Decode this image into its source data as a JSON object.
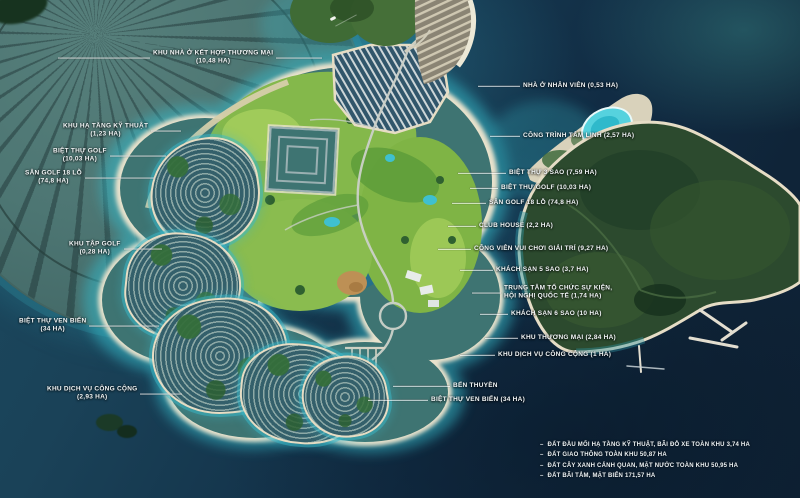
{
  "palette": {
    "ocean_deep": "#112a40",
    "ocean_mid": "#1d4a60",
    "shallow": "#3ab8c8",
    "sand": "#e9e2cc",
    "golf_green": "#85b94c",
    "golf_dark": "#5d9c3a",
    "forest_green": "#2c4a2e",
    "villa_base": "#3e7472",
    "fan_land": "#4e7876",
    "lagoon": "#56d2de",
    "label_text": "#f2f6f7",
    "leader_line": "rgba(255,255,255,0.8)"
  },
  "map_labels": [
    {
      "id": "khu-nha-o-ket-hop-thuong-mai",
      "side": "left",
      "x": 58,
      "y": 58,
      "pre": 92,
      "post": 46,
      "lines": [
        "KHU NHÀ Ở KẾT HỢP THƯƠNG MẠI",
        "(10,48 HA)"
      ]
    },
    {
      "id": "khu-ha-tang-ky-thuat",
      "side": "left",
      "x": 60,
      "y": 131,
      "pre": 0,
      "post": 30,
      "lines": [
        "KHU HẠ TẦNG KỸ THUẬT",
        "(1,23 HA)"
      ]
    },
    {
      "id": "biet-thu-golf-left",
      "side": "left",
      "x": 50,
      "y": 156,
      "pre": 0,
      "post": 56,
      "lines": [
        "BIỆT THỰ GOLF",
        "(10,03 HA)"
      ]
    },
    {
      "id": "san-golf-18-lo-left",
      "side": "left",
      "x": 22,
      "y": 178,
      "pre": 0,
      "post": 70,
      "lines": [
        "SÂN GOLF 18 LỖ",
        "(74,8 HA)"
      ]
    },
    {
      "id": "khu-tap-golf",
      "side": "left",
      "x": 66,
      "y": 249,
      "pre": 0,
      "post": 38,
      "lines": [
        "KHU TẬP GOLF",
        "(0,28 HA)"
      ]
    },
    {
      "id": "biet-thu-ven-bien-left",
      "side": "left",
      "x": 16,
      "y": 326,
      "pre": 0,
      "post": 70,
      "lines": [
        "BIỆT THỰ VEN BIỂN",
        "(34 HA)"
      ]
    },
    {
      "id": "khu-dich-vu-cong-cong-left",
      "side": "left",
      "x": 44,
      "y": 394,
      "pre": 0,
      "post": 42,
      "lines": [
        "KHU DỊCH VỤ CÔNG CỘNG",
        "(2,93 HA)"
      ]
    },
    {
      "id": "nha-o-nhan-vien",
      "side": "right",
      "x": 478,
      "y": 86,
      "pre": 42,
      "post": 0,
      "lines": [
        "NHÀ Ở NHÂN VIÊN (0,53 HA)"
      ]
    },
    {
      "id": "cong-trinh-tam-linh",
      "side": "right",
      "x": 490,
      "y": 136,
      "pre": 30,
      "post": 0,
      "lines": [
        "CÔNG TRÌNH TÂM LINH (2,57 HA)"
      ]
    },
    {
      "id": "biet-thu-3-sao",
      "side": "right",
      "x": 458,
      "y": 173,
      "pre": 48,
      "post": 0,
      "lines": [
        "BIỆT THỰ 3 SAO (7,59 HA)"
      ]
    },
    {
      "id": "biet-thu-golf-right",
      "side": "right",
      "x": 470,
      "y": 188,
      "pre": 28,
      "post": 0,
      "lines": [
        "BIỆT THỰ GOLF (10,03 HA)"
      ]
    },
    {
      "id": "san-golf-18-lo-right",
      "side": "right",
      "x": 452,
      "y": 203,
      "pre": 34,
      "post": 0,
      "lines": [
        "SÂN GOLF 18 LỖ (74,8 HA)"
      ]
    },
    {
      "id": "club-house",
      "side": "right",
      "x": 448,
      "y": 226,
      "pre": 28,
      "post": 0,
      "lines": [
        "CLUB HOUSE (2,2 HA)"
      ]
    },
    {
      "id": "cong-vien-vui-choi-giai-tri",
      "side": "right",
      "x": 438,
      "y": 249,
      "pre": 33,
      "post": 0,
      "lines": [
        "CÔNG VIÊN VUI CHƠI GIẢI TRÍ (9,27 HA)"
      ]
    },
    {
      "id": "khach-san-5-sao",
      "side": "right",
      "x": 460,
      "y": 270,
      "pre": 33,
      "post": 0,
      "lines": [
        "KHÁCH SẠN 5 SAO (3,7 HA)"
      ]
    },
    {
      "id": "trung-tam-su-kien",
      "side": "right",
      "x": 472,
      "y": 293,
      "pre": 29,
      "post": 0,
      "lines": [
        "TRUNG TÂM  TỔ CHỨC SỰ KIỆN,",
        "HỘI NGHỊ QUỐC TẾ  (1,74 HA)"
      ]
    },
    {
      "id": "khach-san-6-sao",
      "side": "right",
      "x": 480,
      "y": 314,
      "pre": 28,
      "post": 0,
      "lines": [
        "KHÁCH SẠN 6 SAO (10 HA)"
      ]
    },
    {
      "id": "khu-thuong-mai",
      "side": "right",
      "x": 485,
      "y": 338,
      "pre": 33,
      "post": 0,
      "lines": [
        "KHU THƯƠNG MẠI (2,84 HA)"
      ]
    },
    {
      "id": "khu-dich-vu-cong-cong-right",
      "side": "right",
      "x": 460,
      "y": 355,
      "pre": 35,
      "post": 0,
      "lines": [
        "KHU DỊCH VỤ CÔNG CỘNG (1 HA)"
      ]
    },
    {
      "id": "ben-thuyen",
      "side": "right",
      "x": 393,
      "y": 386,
      "pre": 57,
      "post": 0,
      "lines": [
        "BẾN THUYỀN"
      ]
    },
    {
      "id": "biet-thu-ven-bien-right",
      "side": "right",
      "x": 368,
      "y": 400,
      "pre": 60,
      "post": 0,
      "lines": [
        "BIỆT THỰ VEN BIỂN (34 HA)"
      ]
    }
  ],
  "legend": {
    "bullet": "–",
    "items": [
      "ĐẤT ĐẦU MỐI HẠ TẦNG KỸ THUẬT, BÃI ĐỖ XE TOÀN KHU 3,74 HA",
      "ĐẤT GIAO THÔNG TOÀN KHU 50,87 HA",
      "ĐẤT CÂY XANH CẢNH QUAN, MẶT NƯỚC  TOÀN KHU 50,95 HA",
      "ĐẤT BÃI TẮM, MẶT BIỂN  171,57 HA"
    ]
  }
}
